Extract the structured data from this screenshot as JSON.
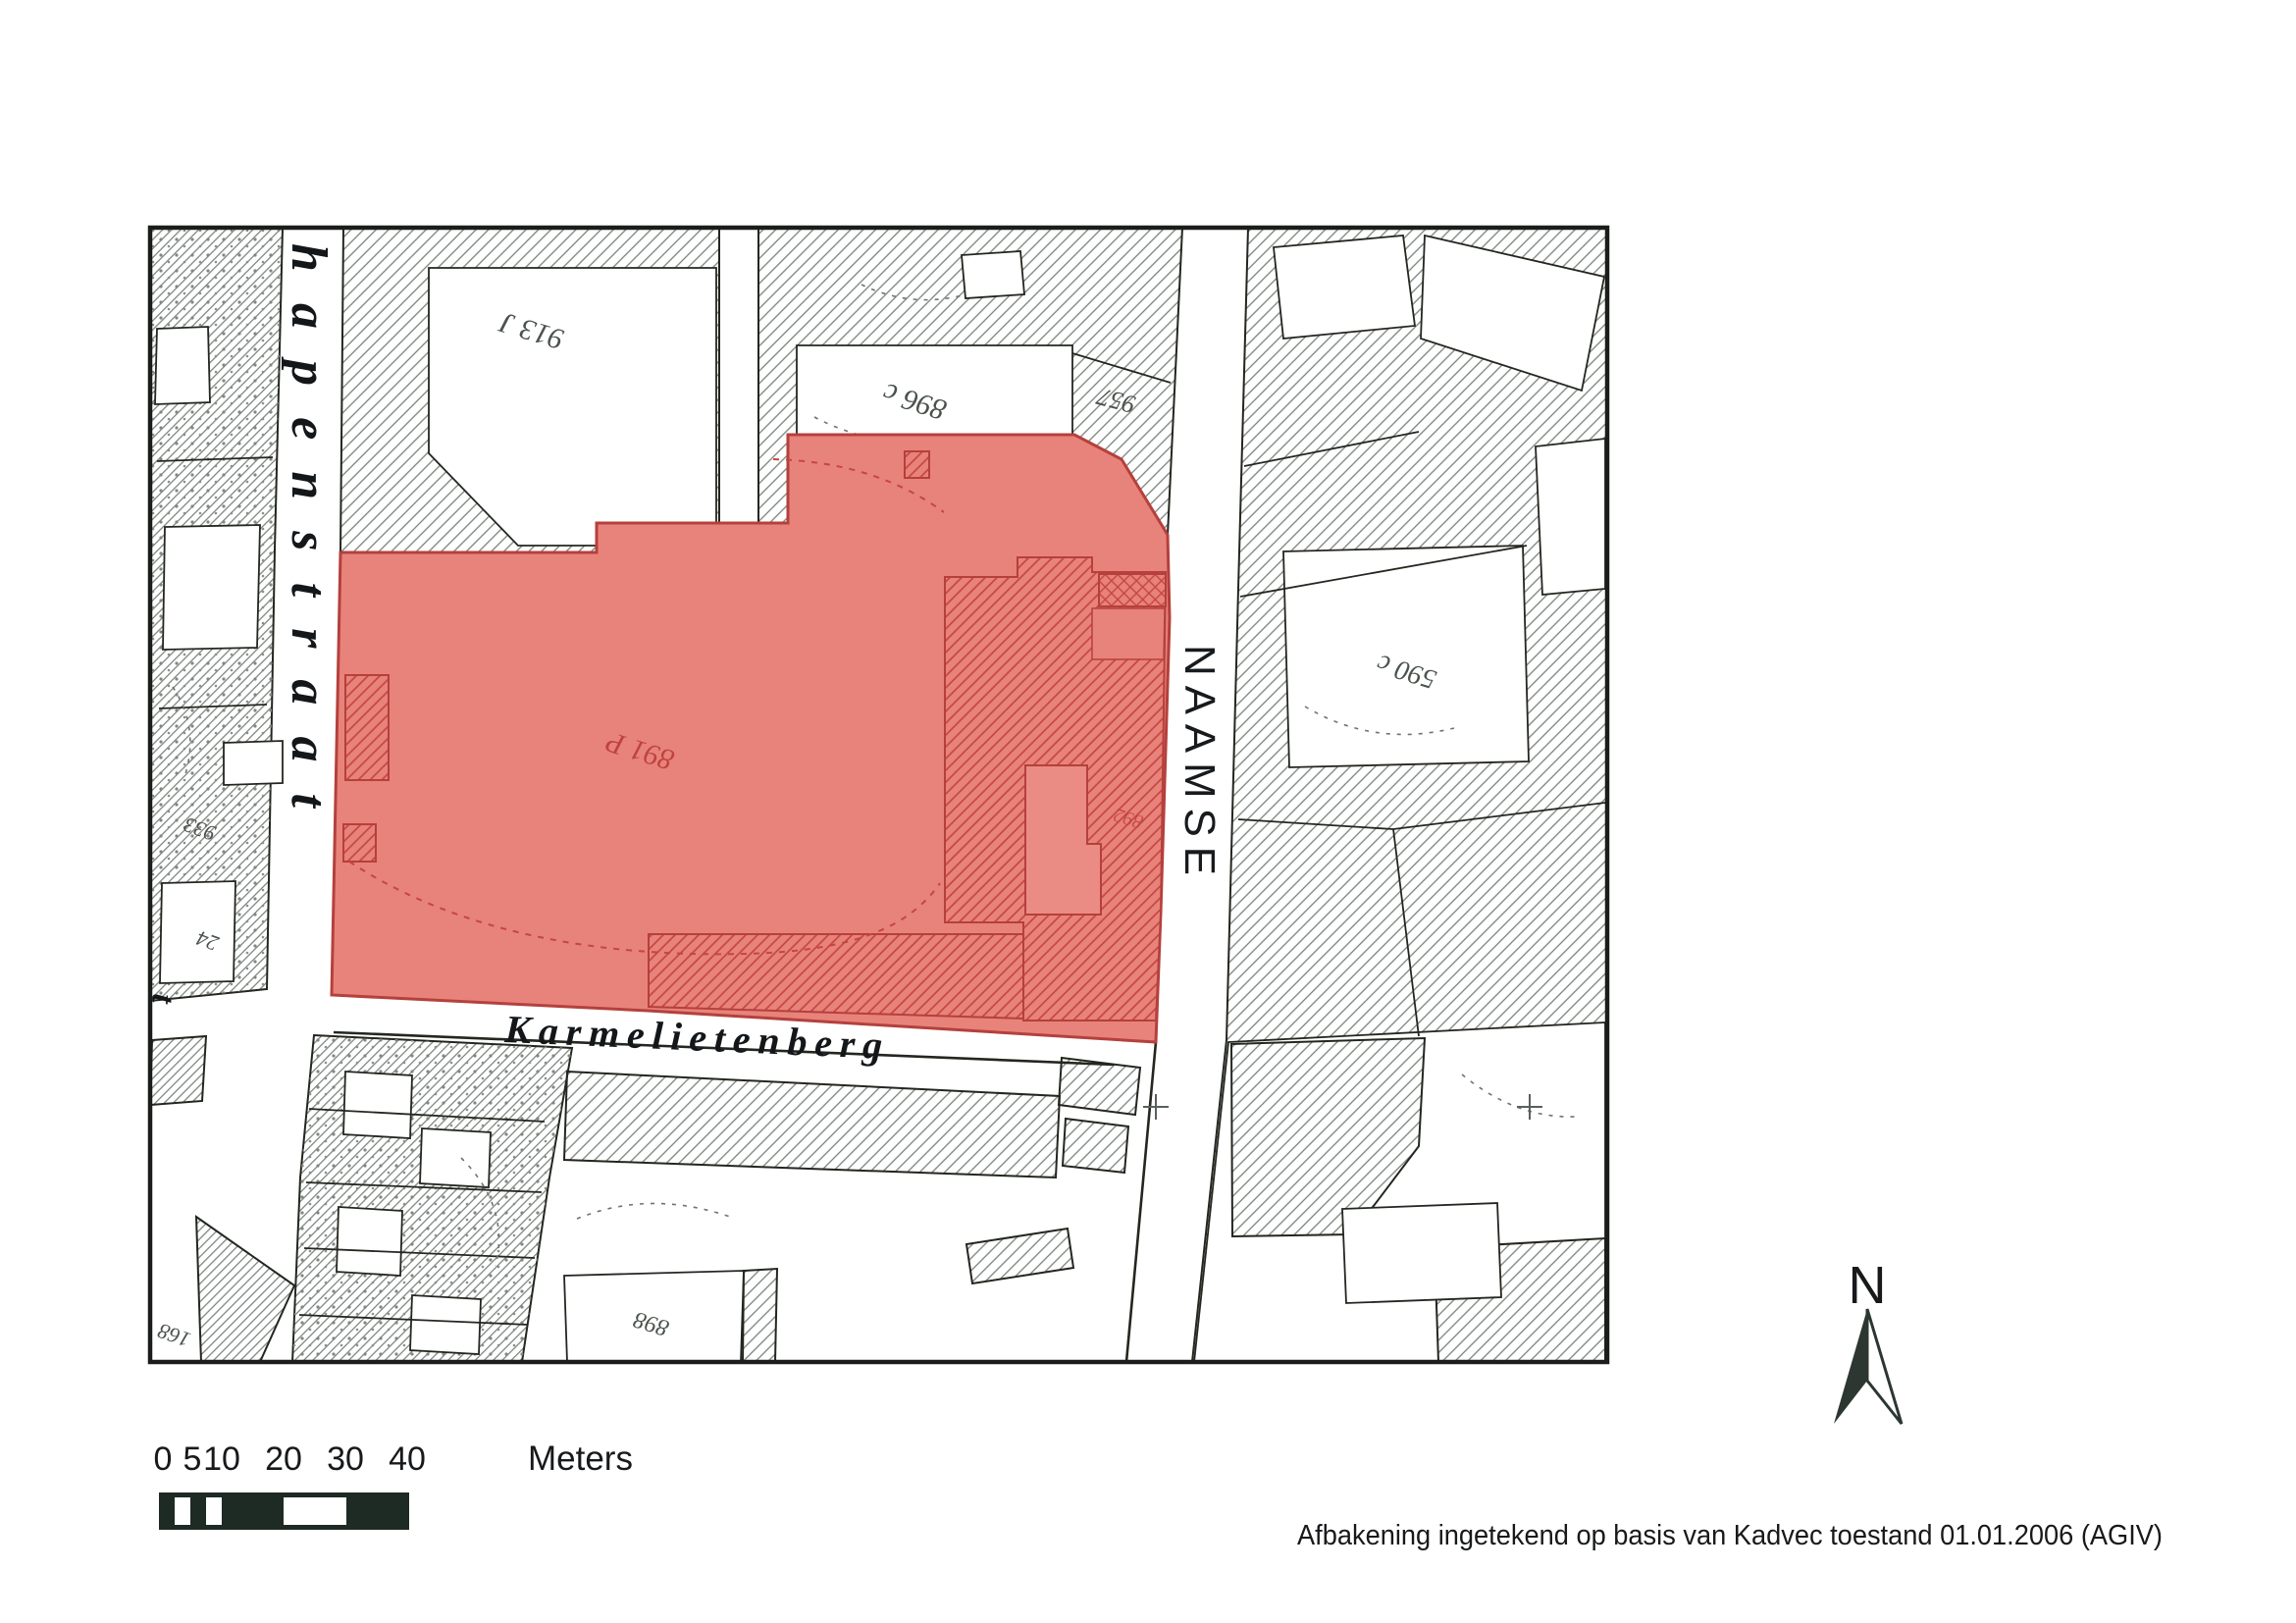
{
  "page": {
    "caption": "Afbakening ingetekend op basis van Kadvec toestand 01.01.2006 (AGIV)"
  },
  "map": {
    "streets": {
      "schapenstraat": "hapenstraat",
      "karmelietenberg": "Karmelietenberg",
      "naamsestraat": "NAAMSE",
      "fragment_left": "t"
    },
    "parcels": {
      "p913": "913 J",
      "p896": "896 c",
      "p957": "957",
      "p891": "891 P",
      "p892": "892",
      "p590": "590 c",
      "p933": "933",
      "p24": "24",
      "p898": "898",
      "p168": "168"
    },
    "colors": {
      "highlight_fill": "#e8837b",
      "highlight_line": "#bf4440",
      "hatch_line": "#78817b",
      "ink": "#23271f"
    }
  },
  "scalebar": {
    "ticks": [
      "0",
      "5",
      "10",
      "20",
      "30",
      "40"
    ],
    "unit_label": "Meters",
    "bar_color": "#1e2a24"
  },
  "north_arrow": {
    "label": "N",
    "color": "#2c3731"
  }
}
